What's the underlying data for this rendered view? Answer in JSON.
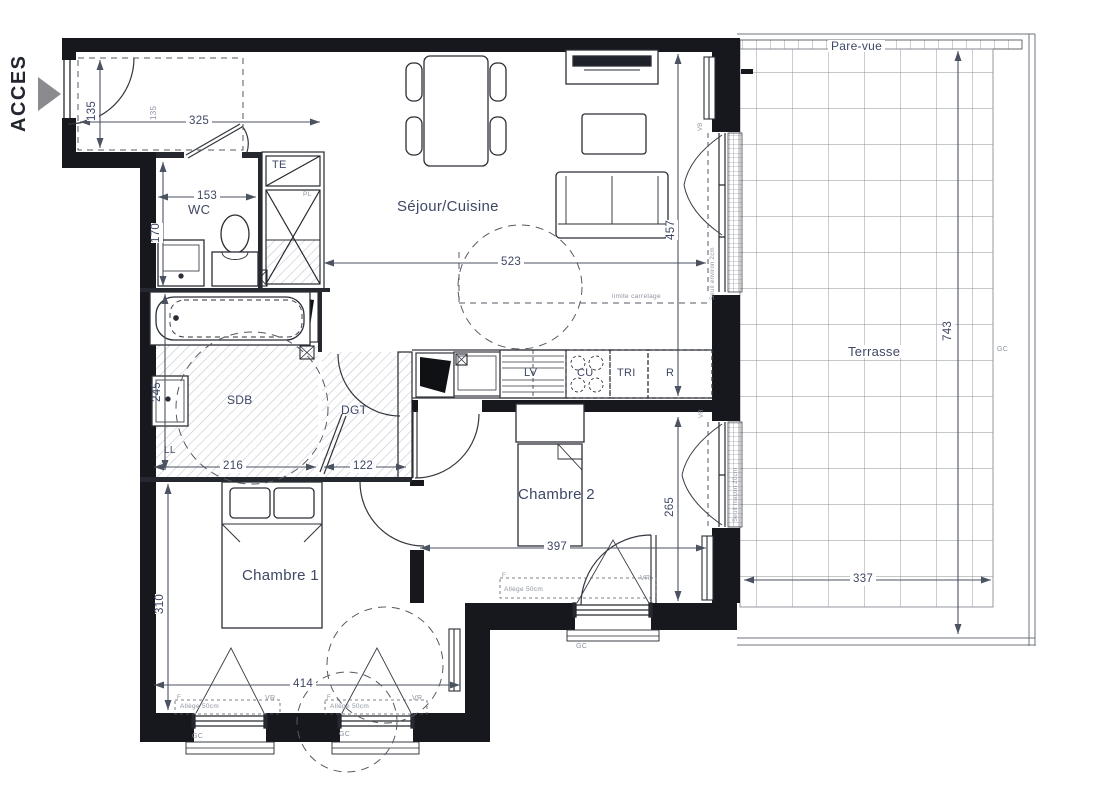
{
  "plan": {
    "acces": "ACCES"
  },
  "terrace": {
    "pare_vue": "Pare-vue",
    "label": "Terrasse",
    "gc": "GC"
  },
  "rooms": {
    "sejour": "Séjour/Cuisine",
    "wc": "WC",
    "sdb": "SDB",
    "dgt": "DGT",
    "chambre1": "Chambre 1",
    "chambre2": "Chambre 2"
  },
  "closet": {
    "te": "TE",
    "pl": "PL"
  },
  "kitchen": {
    "lv": "LV",
    "cu": "CU",
    "tri": "TRI",
    "r": "R",
    "limite": "limite carrelage"
  },
  "laundry": {
    "ll": "LL"
  },
  "window_labels": {
    "allege": "Allège 50cm",
    "vr": "VR",
    "f": "F",
    "gc": "GC",
    "vb": "VB",
    "seuil_env": "Seuil environ 2cm",
    "seuil_mac": "Seuil maçon 20cm"
  },
  "dims": {
    "entry_h": "135",
    "entry_w": "325",
    "wc_w": "153",
    "wc_h": "170",
    "sejour_w": "523",
    "sejour_h": "457",
    "sdb_w": "216",
    "sdb_h": "245",
    "dgt_w": "122",
    "ch1_h": "310",
    "ch1_w": "414",
    "ch2_w": "397",
    "ch2_h": "265",
    "terrace_h": "743",
    "terrace_w": "337",
    "ghost": "135"
  },
  "colors": {
    "wall": "#17181d",
    "line": "#2b2e36",
    "dim": "#4b5260",
    "text": "#3e4765",
    "muted": "#8d93a0"
  }
}
